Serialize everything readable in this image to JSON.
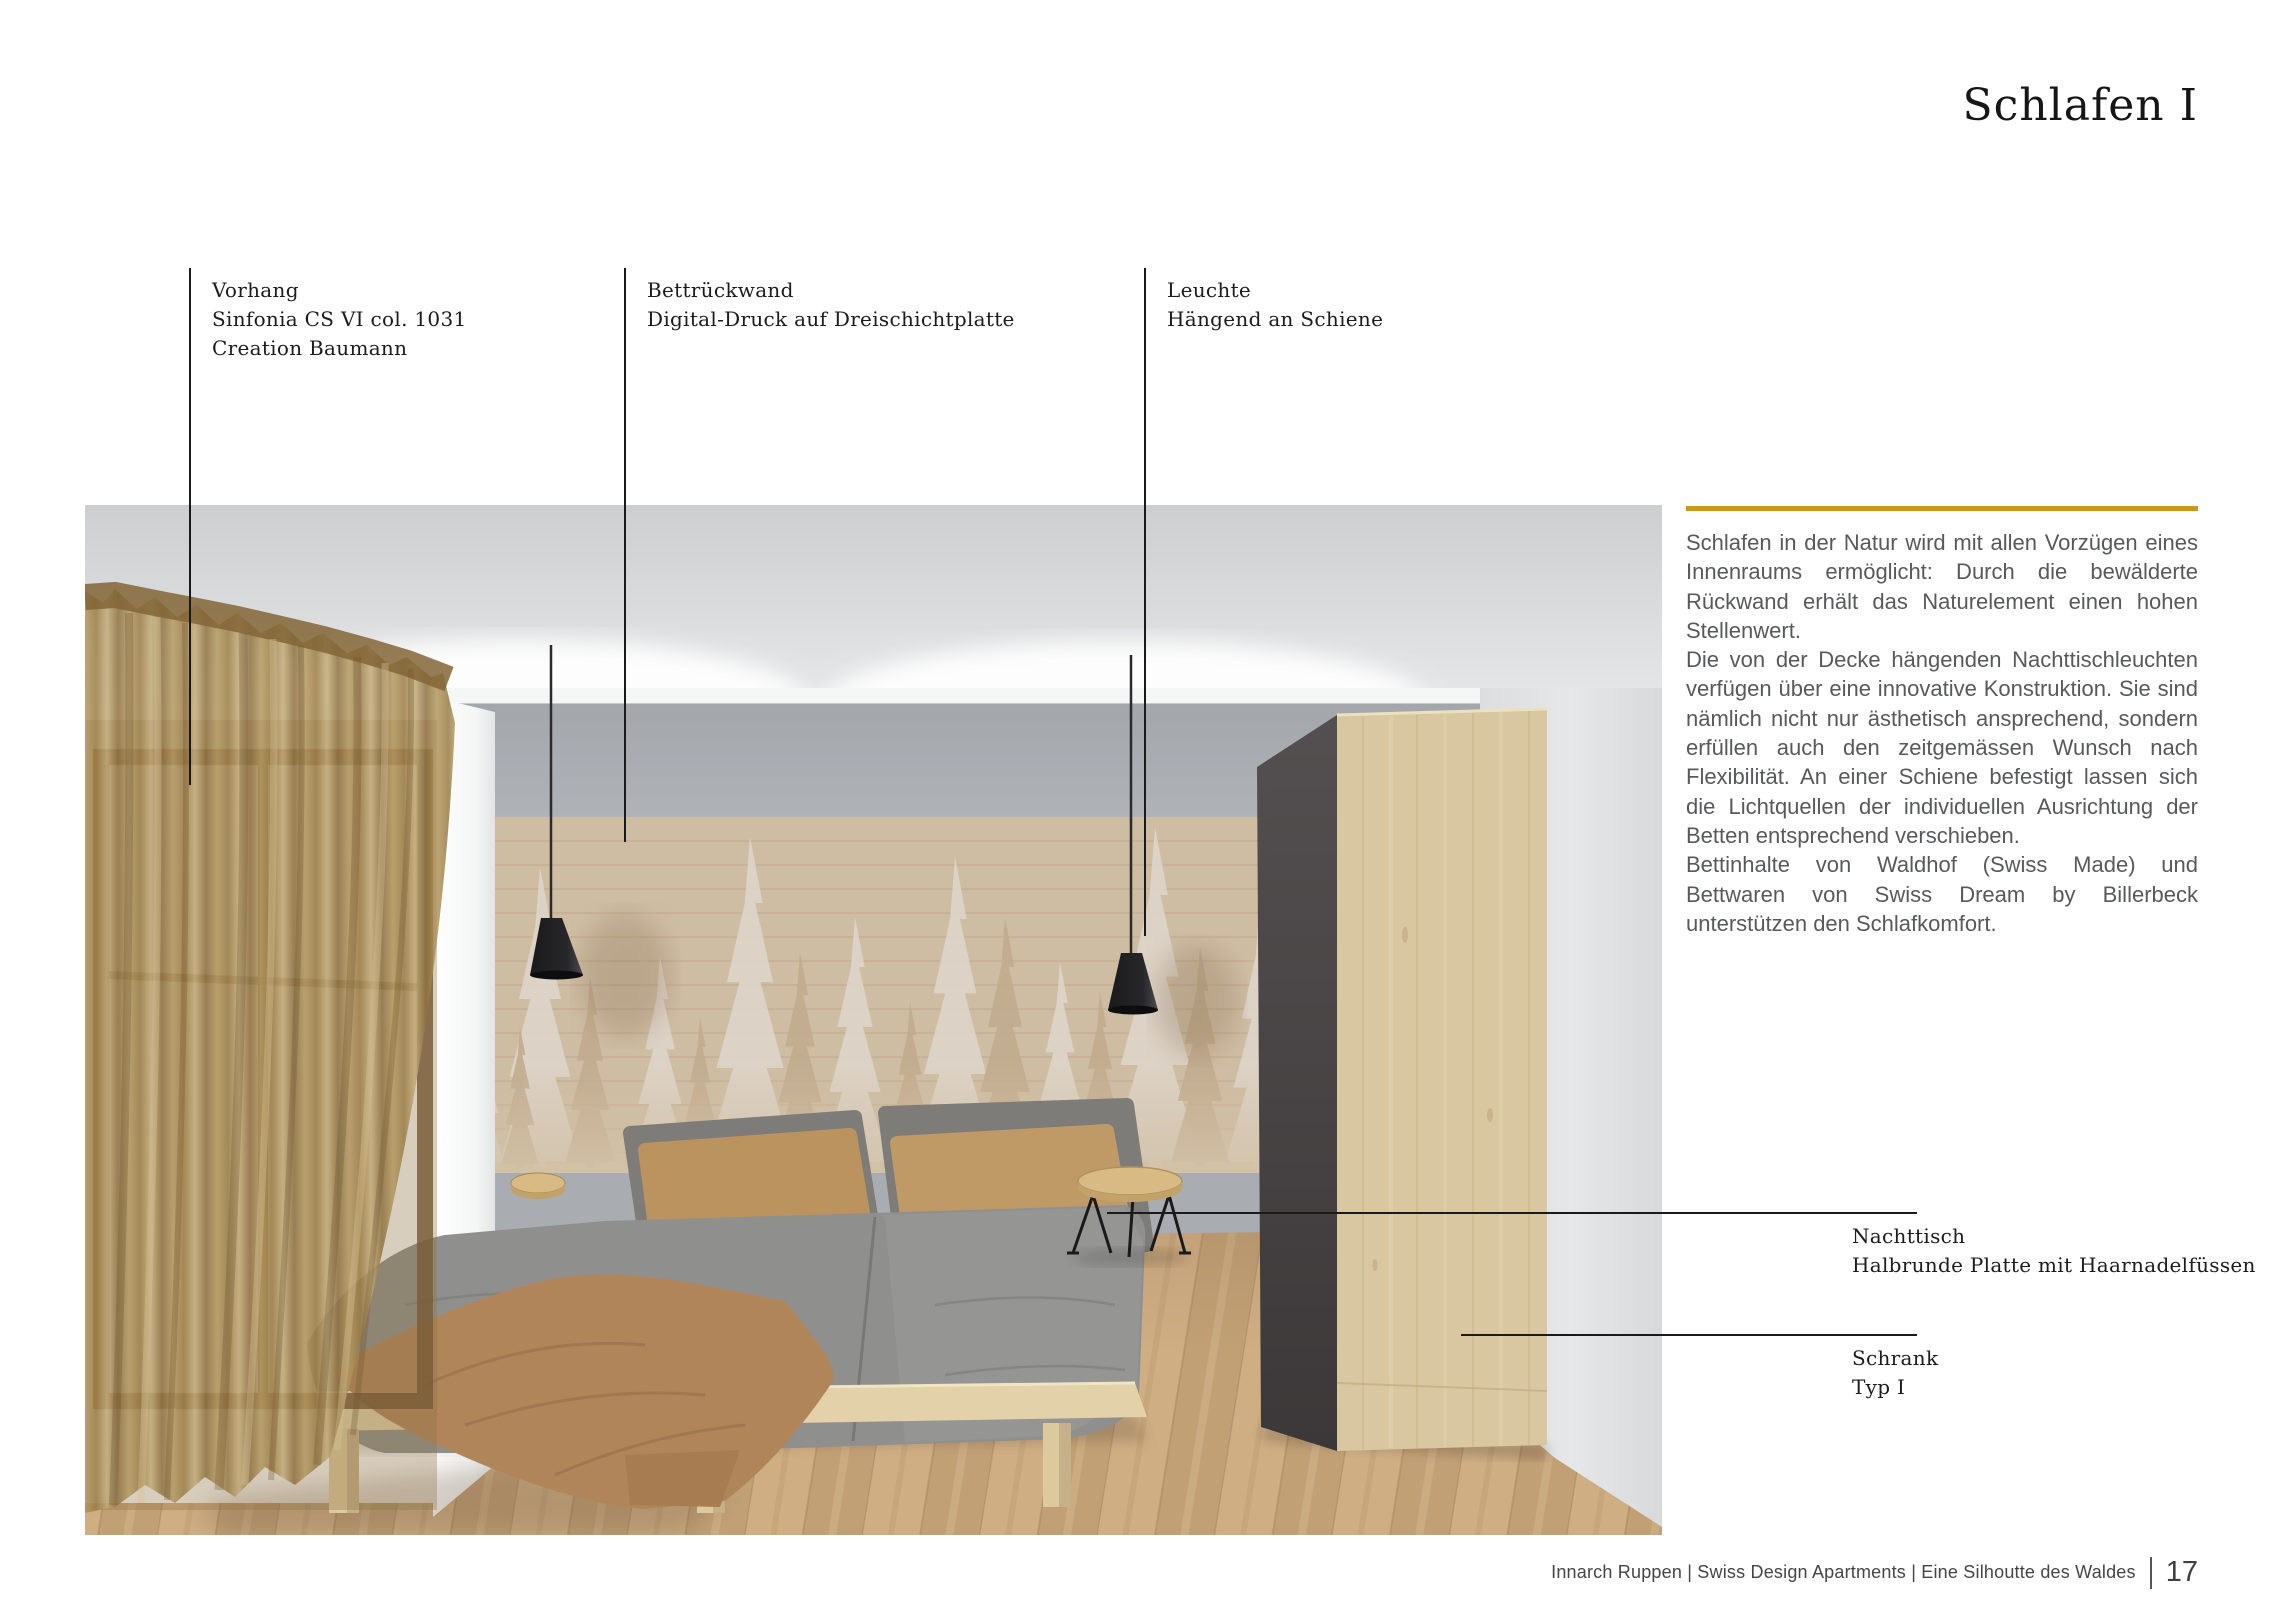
{
  "page": {
    "title": "Schlafen I",
    "accent_color": "#c9991f",
    "footer": {
      "credit": "Innarch Ruppen | Swiss Design Apartments | Eine Silhoutte des Waldes",
      "page_number": "17"
    }
  },
  "annotations": {
    "vorhang": {
      "lines": [
        "Vorhang",
        "Sinfonia CS VI col. 1031",
        "Creation Baumann"
      ]
    },
    "bettrueckwand": {
      "lines": [
        "Bettrückwand",
        "Digital-Druck auf Dreischichtplatte"
      ]
    },
    "leuchte": {
      "lines": [
        "Leuchte",
        "Hängend an Schiene"
      ]
    },
    "nachttisch": {
      "lines": [
        "Nachttisch",
        "Halbrunde Platte mit Haarnadelfüssen"
      ]
    },
    "schrank": {
      "lines": [
        "Schrank",
        "Typ I"
      ]
    }
  },
  "body_text": {
    "paragraphs": [
      "Schlafen in der Natur wird mit allen Vorzügen eines Innenraums ermöglicht: Durch die bewälderte Rückwand erhält das Naturelement einen hohen Stellenwert.",
      "Die von der Decke hängenden Nachttischleuchten verfügen über eine innovative Konstruktion. Sie sind nämlich nicht nur ästhetisch ansprechend, sondern erfüllen auch den zeitgemässen Wunsch nach Flexibilität. An einer Schiene befestigt lassen sich die Lichtquellen der individuellen Ausrichtung der Betten entsprechend verschieben.",
      "Bettinhalte von Waldhof (Swiss Made) und Bettwaren von Swiss Dream by Billerbeck unterstützen den Schlafkomfort."
    ]
  },
  "rendering": {
    "colors": {
      "ceiling": "#d6d7d9",
      "wall_gray": "#a8acb1",
      "mural_wood": "#cfbda3",
      "mural_tree_light": "#ddd4c7",
      "mural_tree_dark": "#c2ac8e",
      "curtain_bronze": "#a98c58",
      "floor_wood": "#c9a87e",
      "duvet_gray": "#8f8f8d",
      "pillow_camel": "#ba935f",
      "bed_frame_wood": "#e2d1a9",
      "pendant_black": "#232325",
      "wardrobe_wood": "#d8c7a0",
      "wardrobe_side_dark": "#4b4748",
      "nightstand_wood": "#d8bb84"
    }
  }
}
